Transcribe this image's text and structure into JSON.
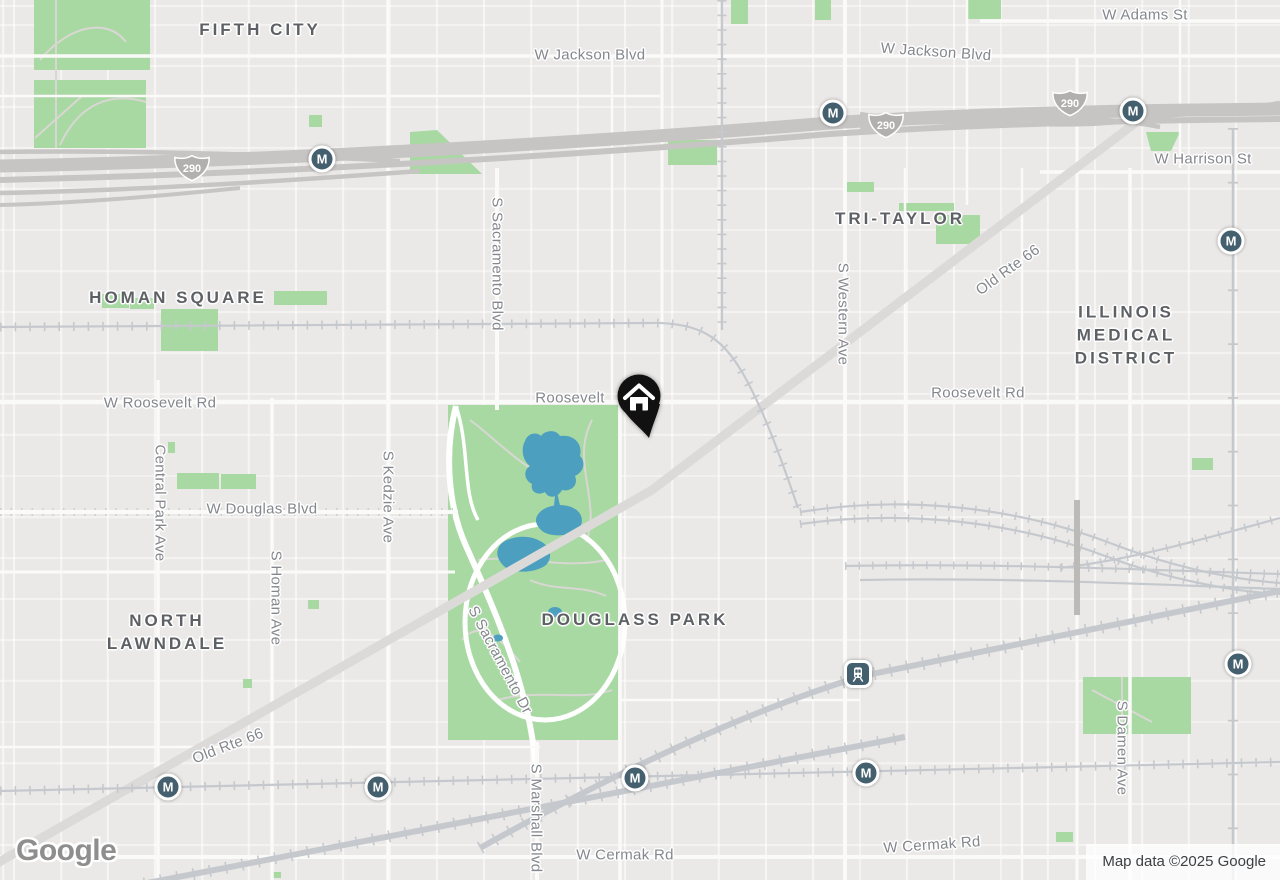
{
  "attribution": {
    "text": "Map data ©2025 Google"
  },
  "logo": {
    "text": "Google"
  },
  "shields": {
    "route": "290"
  },
  "markers": {
    "metro_letter": "M"
  },
  "neighborhoods": {
    "fifth_city": "FIFTH CITY",
    "homan_square": "HOMAN SQUARE",
    "tri_taylor": "TRI-TAYLOR",
    "imd_line1": "ILLINOIS",
    "imd_line2": "MEDICAL",
    "imd_line3": "DISTRICT",
    "north_lawndale_line1": "NORTH",
    "north_lawndale_line2": "LAWNDALE",
    "douglass_park": "DOUGLASS PARK"
  },
  "streets": {
    "w_adams": "W Adams St",
    "w_jackson_left": "W Jackson Blvd",
    "w_jackson_right": "W Jackson Blvd",
    "w_harrison": "W Harrison St",
    "w_roosevelt": "W Roosevelt Rd",
    "roosevelt_mid": "Roosevelt",
    "roosevelt_right": "Roosevelt Rd",
    "w_douglas": "W Douglas Blvd",
    "w_cermak_left": "W Cermak Rd",
    "w_cermak_right": "W Cermak Rd",
    "old_rte66_sw": "Old Rte 66",
    "old_rte66_ne": "Old Rte 66",
    "central_park_ave": "Central Park Ave",
    "s_homan_ave": "S Homan Ave",
    "s_kedzie_ave": "S Kedzie Ave",
    "s_sacramento_blvd": "S Sacramento Blvd",
    "s_sacramento_dr": "S Sacramento Dr",
    "s_marshall_blvd": "S Marshall Blvd",
    "s_western_ave": "S Western Ave",
    "s_damen_ave": "S Damen Ave"
  },
  "colors": {
    "park": "#a8d9a2",
    "water": "#4d9fbf",
    "transit": "#44606e",
    "pin": "#111111"
  }
}
